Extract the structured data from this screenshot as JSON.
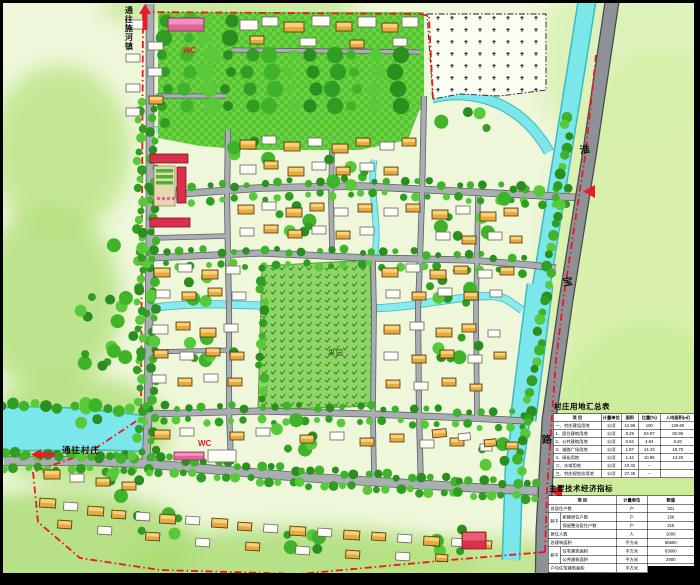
{
  "palette": {
    "boundary_red": "#ef1420",
    "arrow_red": "#e81a2c",
    "water_cyan": "#7ce7ea",
    "park_green": "#57c431",
    "orchard_green": "#8fd466",
    "road_gray": "#a9aeb2",
    "highway_gray": "#8e9296",
    "house_orange": "#e8a93e",
    "public_pink": "#e0639a",
    "public_red": "#d92f48",
    "wash_green": "#b9e281"
  },
  "labels": {
    "to_town": "通往施河镇",
    "to_village": "通往村庄",
    "wc_labels": [
      "WC",
      "WC"
    ],
    "road_name_chars": [
      "淮",
      "宝",
      "路"
    ],
    "orchard": "果园"
  },
  "land_use_table": {
    "title": "村庄用地汇总表",
    "headers": [
      "项    目",
      "计量单位",
      "面积",
      "比重(%)",
      "人均面积(㎡)"
    ],
    "rows": [
      [
        "一、村庄建设用地",
        "公顷",
        "12.96",
        "100",
        "129.60"
      ],
      [
        "1、居住建筑用地",
        "公顷",
        "8.29",
        "63.97",
        "82.90"
      ],
      [
        "2、公共建筑用地",
        "公顷",
        "0.62",
        "4.84",
        "6.20"
      ],
      [
        "3、道路广场用地",
        "公顷",
        "1.87",
        "14.43",
        "18.70"
      ],
      [
        "4、绿化用地",
        "公顷",
        "1.42",
        "10.96",
        "14.20"
      ],
      [
        "二、水域用地",
        "公顷",
        "10.32",
        "--",
        ""
      ],
      [
        "三、村庄规划总用地",
        "公顷",
        "27.36",
        "--",
        ""
      ]
    ]
  },
  "indicators_table": {
    "title": "主要技术经济指标",
    "headers": [
      "项    目",
      "计量单位",
      "数值"
    ],
    "rows": [
      {
        "group": "",
        "item": "总居住户数",
        "unit": "户",
        "value": "321"
      },
      {
        "group": "其中",
        "item": "新建居住户数",
        "unit": "户",
        "value": "106"
      },
      {
        "group": "其中",
        "item": "保留整治居住户数",
        "unit": "户",
        "value": "215"
      },
      {
        "group": "",
        "item": "居住人数",
        "unit": "人",
        "value": "1000"
      },
      {
        "group": "",
        "item": "总建筑面积",
        "unit": "平方米",
        "value": "66500"
      },
      {
        "group": "其中",
        "item": "住宅建筑面积",
        "unit": "平方米",
        "value": "63600"
      },
      {
        "group": "其中",
        "item": "公共建筑面积",
        "unit": "平方米",
        "value": "2900"
      },
      {
        "group": "",
        "item": "户均住宅建筑面积",
        "unit": "平方米",
        "value": "145.58"
      }
    ]
  }
}
